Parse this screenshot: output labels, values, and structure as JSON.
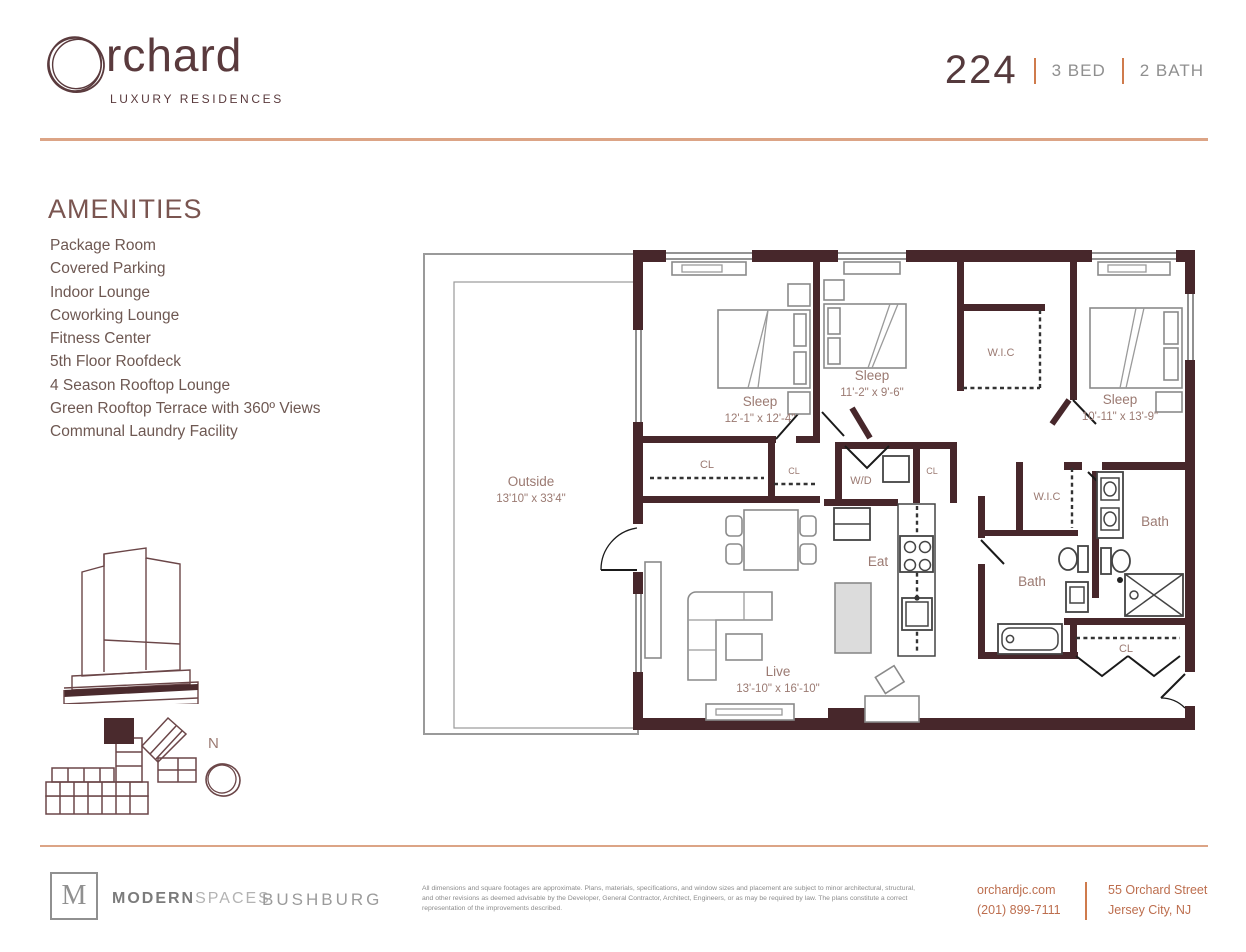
{
  "header": {
    "logo": {
      "wordmark_rest": "rchard",
      "tagline": "LUXURY RESIDENCES"
    },
    "unit": {
      "number": "224",
      "beds": "3 BED",
      "baths": "2 BATH"
    }
  },
  "amenities": {
    "title": "AMENITIES",
    "items": [
      "Package Room",
      "Covered Parking",
      "Indoor Lounge",
      "Coworking Lounge",
      "Fitness Center",
      "5th Floor Roofdeck",
      "4 Season Rooftop Lounge",
      "Green Rooftop Terrace with 360º Views",
      "Communal Laundry Facility"
    ]
  },
  "floorplan": {
    "rooms": {
      "outside": {
        "label": "Outside",
        "dims": "13'10\" x 33'4\""
      },
      "sleep1": {
        "label": "Sleep",
        "dims": "12'-1\" x 12'-4\""
      },
      "sleep2": {
        "label": "Sleep",
        "dims": "11'-2\" x 9'-6\""
      },
      "sleep3": {
        "label": "Sleep",
        "dims": "10'-11\" x 13'-9\""
      },
      "live": {
        "label": "Live",
        "dims": "13'-10\" x 16'-10\""
      },
      "eat": {
        "label": "Eat"
      },
      "wd": {
        "label": "W/D"
      },
      "wic1": {
        "label": "W.I.C"
      },
      "wic2": {
        "label": "W.I.C"
      },
      "bath1": {
        "label": "Bath"
      },
      "bath2": {
        "label": "Bath"
      },
      "cl1": {
        "label": "CL"
      },
      "cl2": {
        "label": "CL"
      },
      "cl3": {
        "label": "CL"
      },
      "cl4": {
        "label": "CL"
      }
    },
    "compass": {
      "label": "N"
    }
  },
  "footer": {
    "modern_spaces": {
      "monogram": "M",
      "bold": "MODERN",
      "light": "SPACES"
    },
    "bushburg": "BUSHBURG",
    "disclaimer": "All dimensions and square footages are approximate. Plans, materials, specifications, and window sizes and placement are subject to minor architectural, structural, and other revisions as deemed advisable by the Developer, General Contractor, Architect, Engineers, or as may be required by law. The plans constitute a correct representation of the improvements described.",
    "contact": {
      "website": "orchardjc.com",
      "phone": "(201) 899-7111"
    },
    "address": {
      "line1": "55 Orchard Street",
      "line2": "Jersey City, NJ"
    }
  },
  "colors": {
    "wall": "#47272b",
    "accent_line": "#dca486",
    "orange": "#cf7b4c",
    "maroon_text": "#5a3a3d",
    "gray_text": "#8f8f8f",
    "terracotta_text": "#bd6e4e"
  }
}
